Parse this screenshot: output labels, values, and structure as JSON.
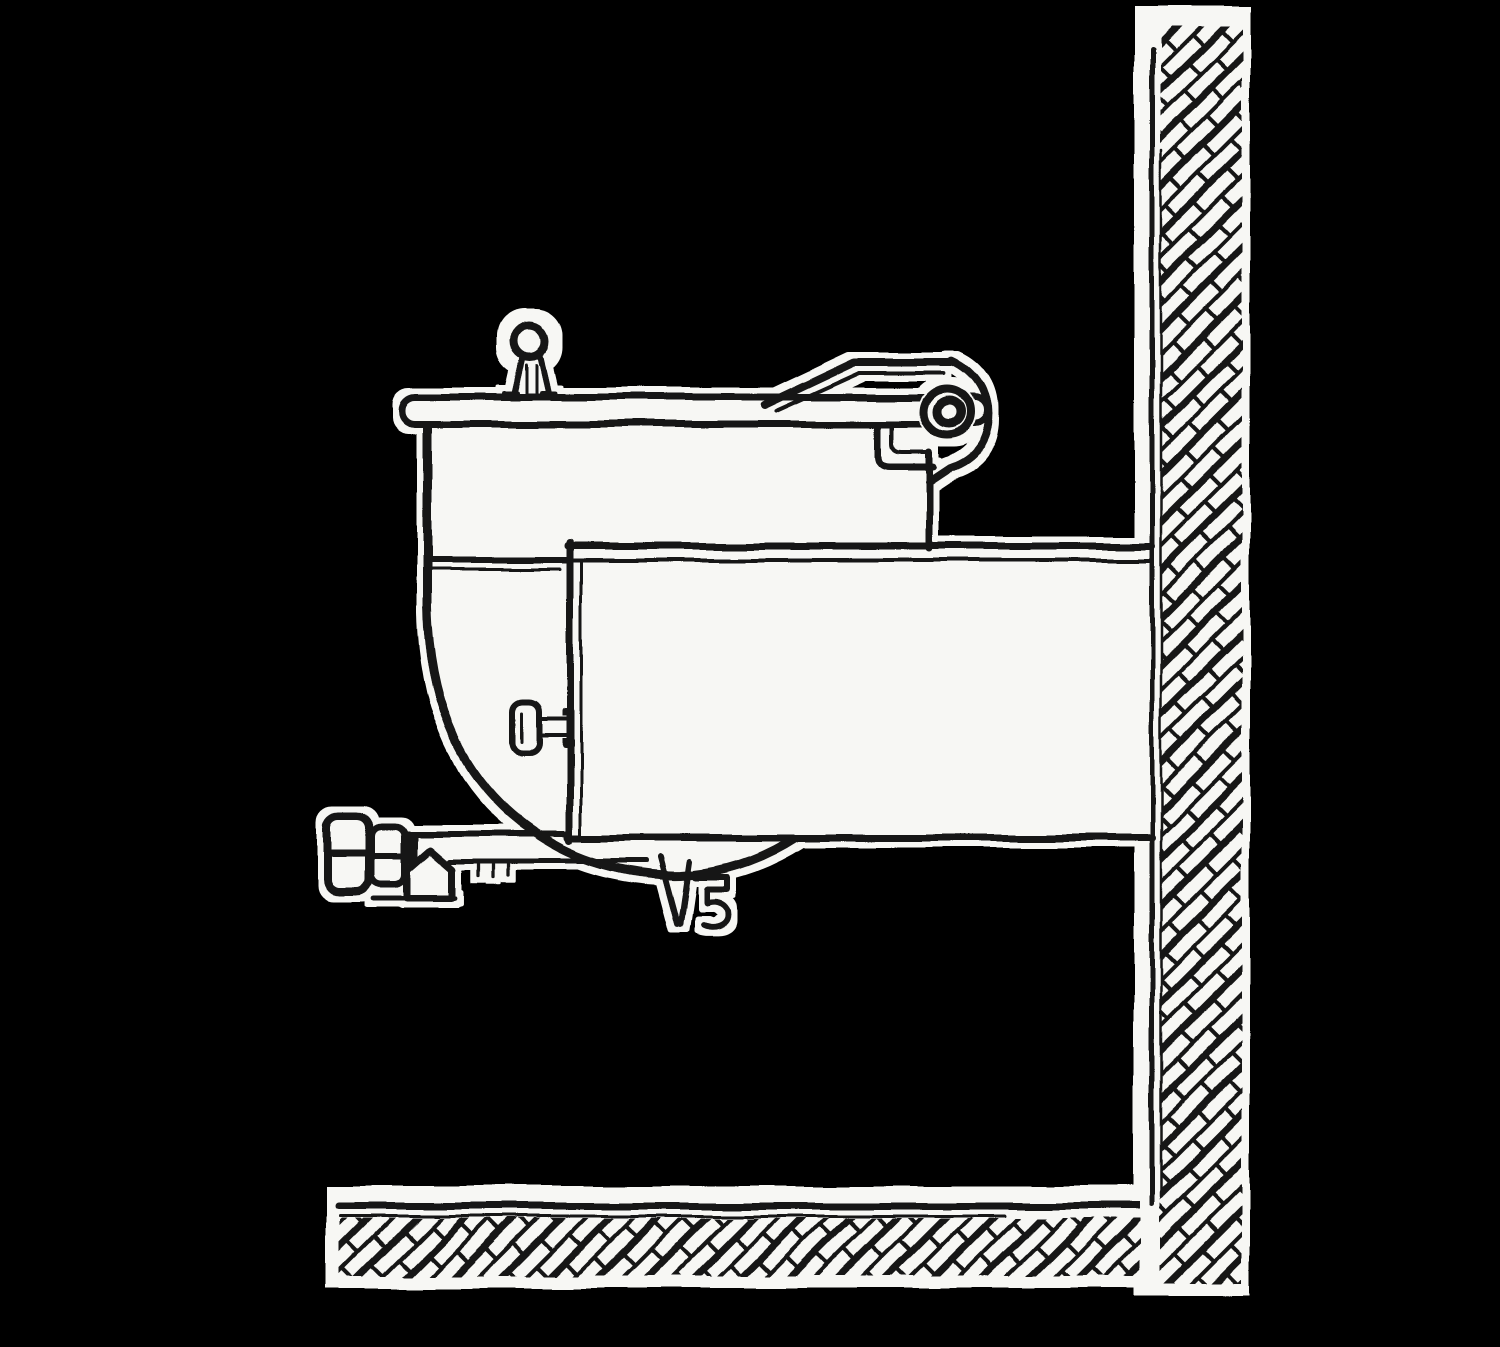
{
  "illustration": {
    "title": "Side-elevation ink line drawing of a wall-mounted steam-jacketed kettle",
    "medium": "black ink linework on white paper cut-outs over a black background",
    "parts": {
      "wall": "masonry wall with diagonal brick hatching",
      "floor": "masonry floor with diagonal brick hatching",
      "lid": "kettle lid bar",
      "knob": "ball-and-stem lid knob",
      "hinge": "rear lid hinge arm with pivot pin",
      "rim_strap": "rim strap bracket below hinge",
      "body": "kettle upper shell",
      "bowl": "hemispherical kettle bottom",
      "housing": "wall-mounted support housing",
      "housing_handle": "small positioning handle on housing",
      "handwheel": "draw-off valve handwheel",
      "valve_bonnet": "valve bonnet (pentagon)",
      "pipe": "draw-off pipe",
      "drain": "bottom drain funnel and spigot"
    }
  },
  "colors": {
    "background": "#000000",
    "paper": "#f7f7f4",
    "ink": "#141414"
  }
}
